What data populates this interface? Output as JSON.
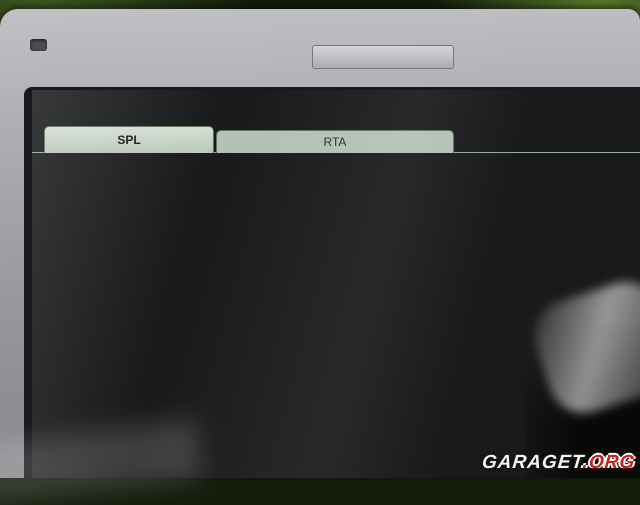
{
  "window": {
    "title": "Term-LAB",
    "menu": [
      "File",
      "View",
      "Tools",
      "Help"
    ],
    "tabs": [
      {
        "label": "SPL",
        "active": true
      },
      {
        "label": "RTA",
        "active": false
      }
    ],
    "channel_label": "Channel A"
  },
  "spl_display": {
    "sensor_caption": "Sensor 3 (MDF Sensor 0001)",
    "digits": "1538",
    "display_value": "153.8",
    "lit_color": "#d8c51e",
    "background": "#060608"
  },
  "readouts": [
    {
      "label": "Real-Time SPL",
      "value": "70.8"
    },
    {
      "label": "Peak SPL",
      "value": "153.8"
    },
    {
      "label": "Average SPL",
      "value": "119.9"
    },
    {
      "label": "Real-Time Fq",
      "value": "190"
    },
    {
      "label": "Peak Fq",
      "value": "49"
    }
  ],
  "timer_panel": {
    "group_label": "Timer",
    "display_text": "SPL",
    "display_color": "#c22014",
    "buttons": [
      "Reset",
      "Start",
      ""
    ]
  },
  "judging_panel": {
    "group_label": "Judging Mode",
    "mode_select_label": "Mode Select",
    "logo_text": "SPL"
  },
  "readout_panel": {
    "group_label": "SPL Readout",
    "options": [
      {
        "label": "Real Time",
        "selected": false
      },
      {
        "label": "Rolling Average",
        "selected": false
      },
      {
        "label": "Peak Hold",
        "selected": true
      }
    ],
    "reset_label": "Reset",
    "update_speed_label": "Update Speed"
  },
  "status_bar": {
    "left": "SPL Mode",
    "center": "Total Competitors: 9",
    "right": "Leaderboard"
  },
  "taskbar": {
    "icons": [
      "windows-start",
      "media-app",
      "browser-orange",
      "internet-explorer",
      "term-lab-window"
    ]
  },
  "watermark": {
    "main": "GARAGET",
    "suffix": ".ORG",
    "suffix_color": "#cc1f1f"
  },
  "chart_data": [
    {
      "type": "bar",
      "orientation": "vertical",
      "axis_ticks": [
        120,
        130,
        140,
        150,
        160,
        170
      ],
      "ylim": [
        120,
        170
      ],
      "value": 153.8,
      "segments": [
        {
          "from": 120,
          "to": 152.5,
          "color": "#c03018"
        },
        {
          "from": 152.5,
          "to": 157.5,
          "color": "#3fae2a"
        },
        {
          "from": 157.5,
          "to": 170,
          "color": "#0c0c0e"
        }
      ]
    },
    {
      "type": "line",
      "title": "Oscilloscope",
      "waveform": "sine",
      "cycles": 44,
      "amplitude": 0.27,
      "ylim": [
        -0.3,
        0.3
      ],
      "xlim": [
        0,
        350
      ],
      "y_tick_labels": [
        "0.3",
        "0.0",
        "-0.3"
      ],
      "x_tick_labels": [
        "0",
        "50",
        "100",
        "150",
        "200",
        "250",
        "300",
        "350"
      ],
      "line_color": "#2fb52f",
      "bg_color": "#0a140a",
      "grid": true,
      "legend": "none",
      "rate_text": "Rate: 512 FFT  512 BW  256 Hz"
    }
  ]
}
